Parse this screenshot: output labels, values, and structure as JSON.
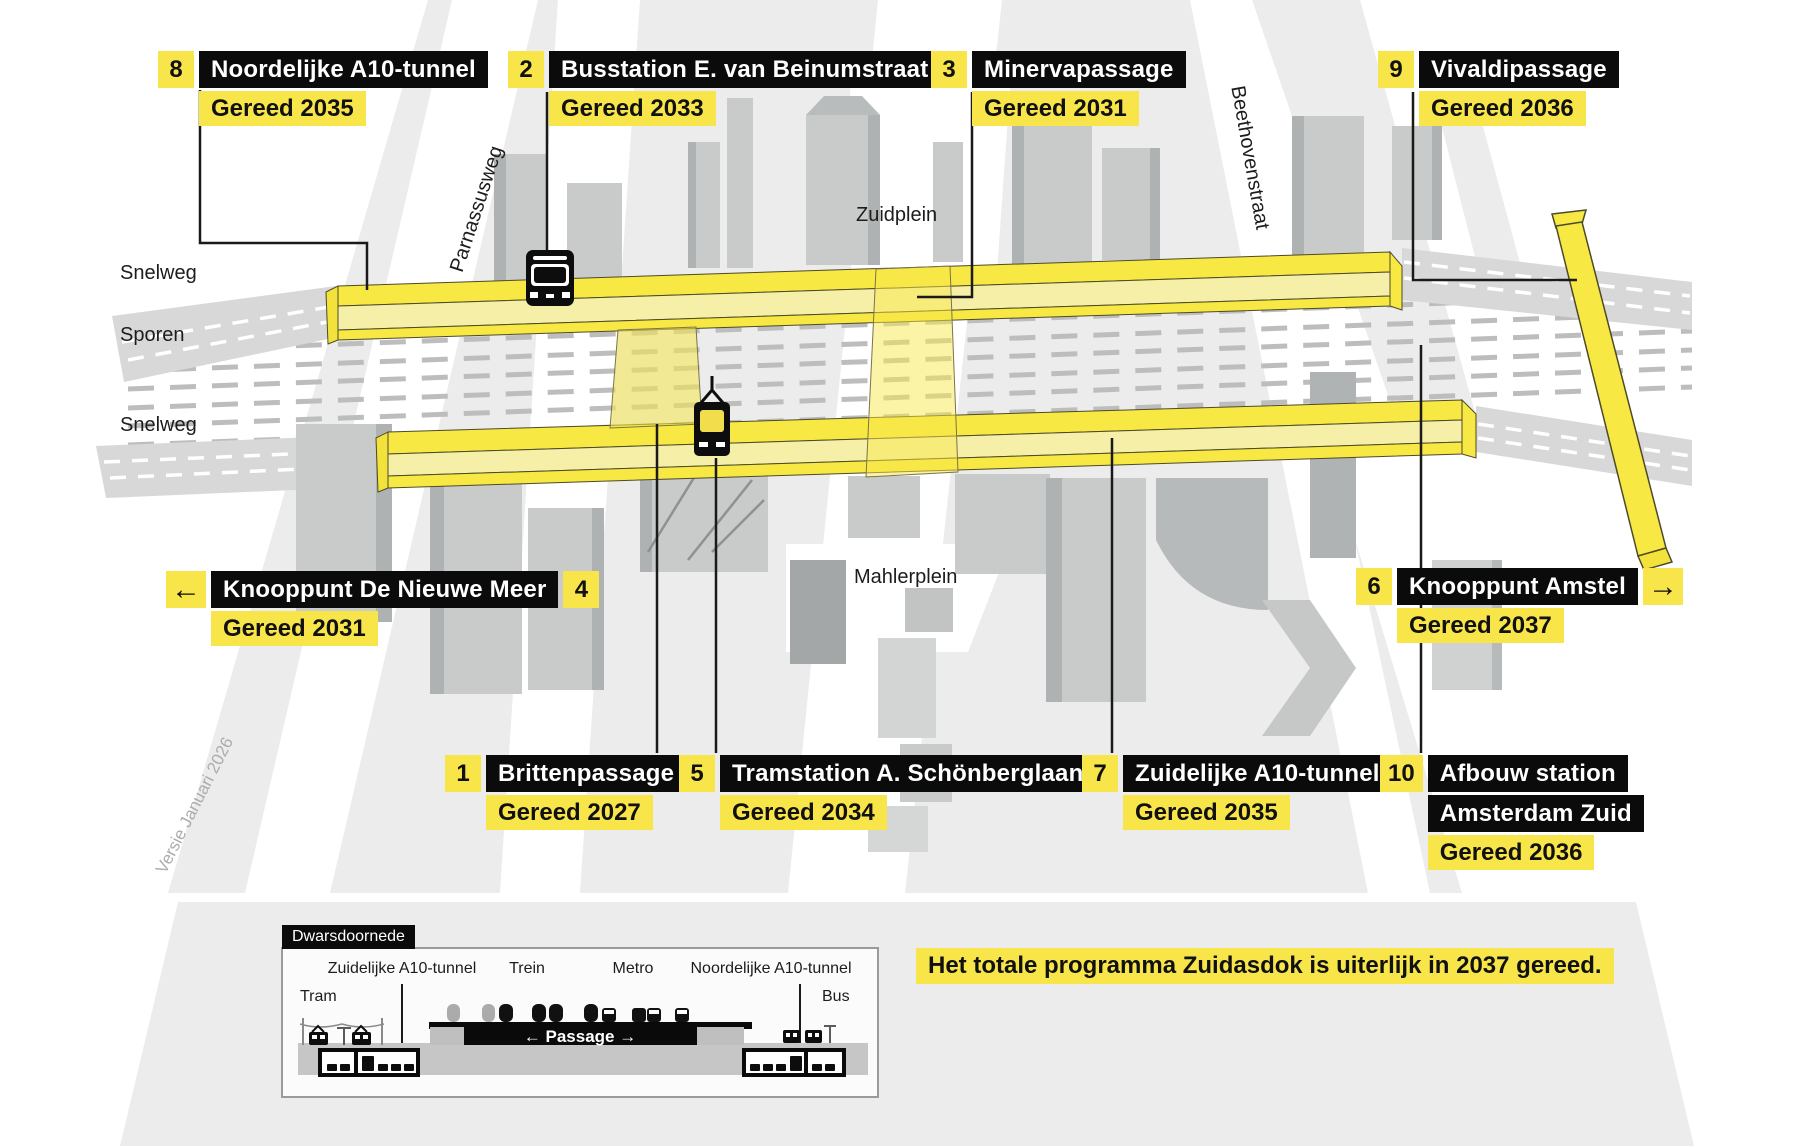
{
  "callouts": [
    {
      "number": "1",
      "title": "Brittenpassage",
      "status": "Gereed 2027"
    },
    {
      "number": "2",
      "title": "Busstation E. van Beinumstraat",
      "status": "Gereed 2033"
    },
    {
      "number": "3",
      "title": "Minervapassage",
      "status": "Gereed 2031"
    },
    {
      "number": "4",
      "title": "Knooppunt De Nieuwe Meer",
      "status": "Gereed 2031",
      "arrow": "←"
    },
    {
      "number": "5",
      "title": "Tramstation A. Schönberglaan",
      "status": "Gereed 2034"
    },
    {
      "number": "6",
      "title": "Knooppunt Amstel",
      "status": "Gereed 2037",
      "arrow": "→"
    },
    {
      "number": "7",
      "title": "Zuidelijke A10-tunnel",
      "status": "Gereed 2035"
    },
    {
      "number": "8",
      "title": "Noordelijke A10-tunnel",
      "status": "Gereed 2035"
    },
    {
      "number": "9",
      "title": "Vivaldipassage",
      "status": "Gereed 2036"
    },
    {
      "number": "10",
      "title": "Afbouw station",
      "title2": "Amsterdam Zuid",
      "status": "Gereed 2036"
    }
  ],
  "map_labels": {
    "snelweg_top": "Snelweg",
    "sporen": "Sporen",
    "snelweg_bottom": "Snelweg",
    "parnassusweg": "Parnassusweg",
    "zuidplein": "Zuidplein",
    "beethovenstraat": "Beethovenstraat",
    "mahlerplein": "Mahlerplein",
    "version_note": "Versie Januari 2026"
  },
  "legend": {
    "title": "Dwarsdoornede",
    "tram": "Tram",
    "zuidelijke_tunnel": "Zuidelijke A10-tunnel",
    "trein": "Trein",
    "metro": "Metro",
    "noordelijke_tunnel": "Noordelijke A10-tunnel",
    "bus": "Bus",
    "passage": "← Passage →"
  },
  "footer": {
    "note": "Het totale programma Zuidasdok is uiterlijk in 2037 gereed."
  },
  "icons": {
    "bus": "bus-icon",
    "tram": "tram-icon",
    "arrow_left": "arrow-left-icon",
    "arrow_right": "arrow-right-icon"
  },
  "colors": {
    "accent_yellow": "#F8E54A",
    "tunnel_yellow": "#F7E843",
    "tunnel_yellow_light": "#F6EFA8",
    "label_black": "#0B0B0B",
    "map_gray": "#ECECEC",
    "building_gray": "#C9CBCB",
    "building_gray_dark": "#AFB2B2",
    "track_dash_gray": "#BDBDBD",
    "road_gray": "#D8D8D8"
  }
}
